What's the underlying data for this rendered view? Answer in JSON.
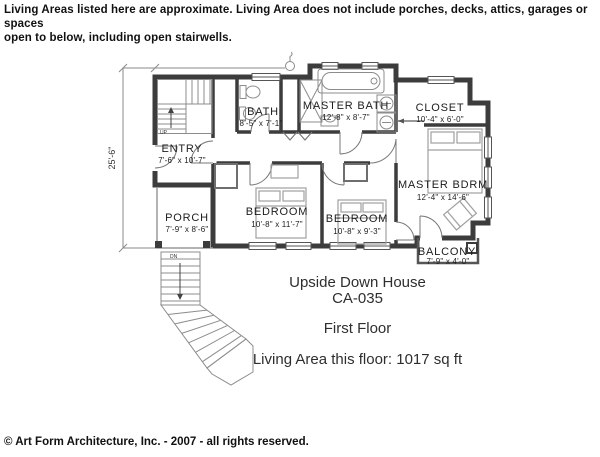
{
  "note": {
    "line1": "Living Areas listed here are approximate.  Living Area does not include porches, decks, attics, garages or spaces",
    "line2": "open to below, including open stairwells."
  },
  "plan": {
    "overall_depth": "25'-6\"",
    "stairs": {
      "up": "UP",
      "down": "DN"
    },
    "rooms": [
      {
        "name": "ENTRY",
        "dims": "7'-6\" x 10'-7\""
      },
      {
        "name": "PORCH",
        "dims": "7'-9\" x 8'-6\""
      },
      {
        "name": "BATH",
        "dims": "8'-5\" x 7'-1\""
      },
      {
        "name": "MASTER BATH",
        "dims": "12'-8\" x 8'-7\""
      },
      {
        "name": "CLOSET",
        "dims": "10'-4\" x 6'-0\""
      },
      {
        "name": "MASTER BDRM",
        "dims": "12'-4\" x 14'-6\""
      },
      {
        "name": "BEDROOM",
        "dims": "10'-8\" x 11'-7\""
      },
      {
        "name": "BEDROOM",
        "dims": "10'-8\" x 9'-3\""
      },
      {
        "name": "BALCONY",
        "dims": "7'-9\" x 4'-0\""
      }
    ]
  },
  "title_block": {
    "house_name": "Upside Down House",
    "plan_id": "CA-035",
    "floor_label": "First Floor",
    "living_area": "Living Area this floor:  1017 sq ft"
  },
  "footer": {
    "copyright": "© Art Form Architecture, Inc. - 2007 - all rights reserved."
  }
}
